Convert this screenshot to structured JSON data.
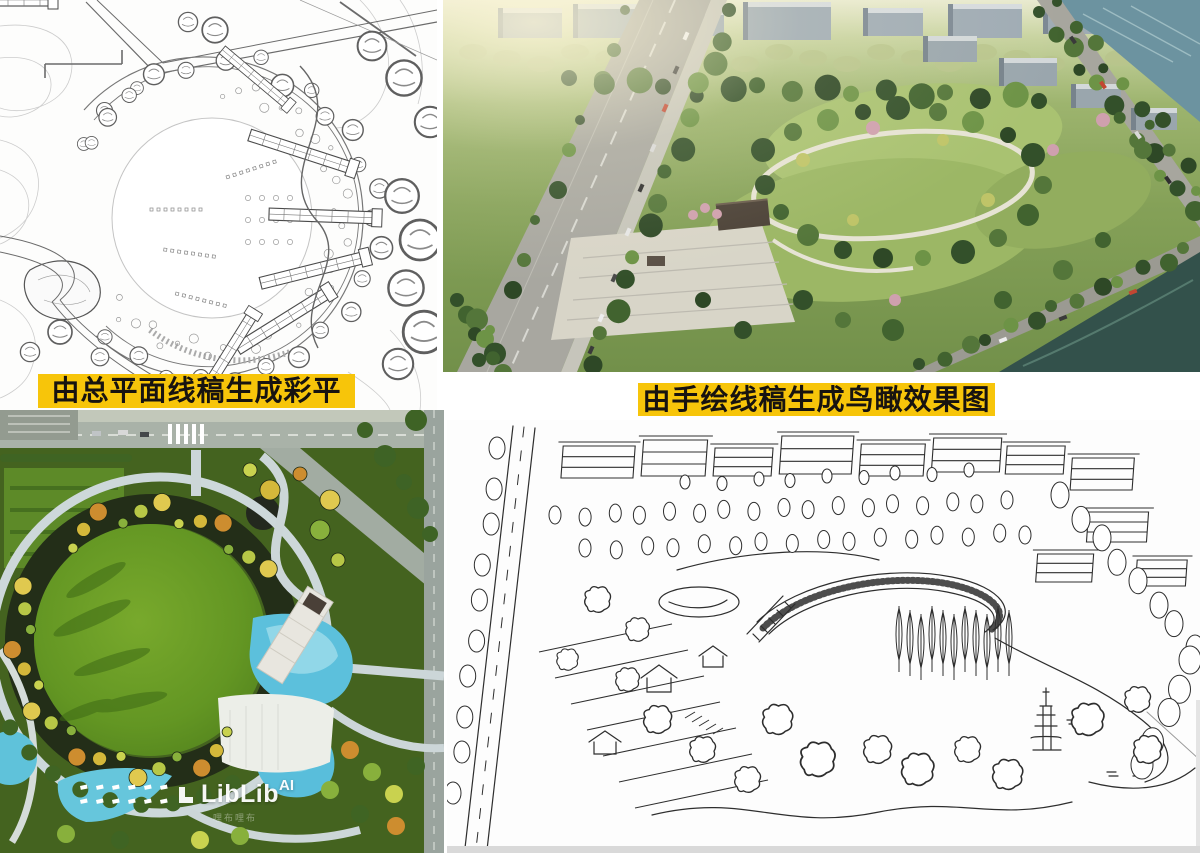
{
  "canvas": {
    "width": 1200,
    "height": 853,
    "background": "#ffffff"
  },
  "captions": {
    "left_banner": {
      "text": "由总平面线稿生成彩平",
      "bg": "#F7C50A",
      "color": "#171310"
    },
    "right_banner": {
      "text": "由手绘线稿生成鸟瞰效果图",
      "bg": "#F7C50A",
      "color": "#171310"
    }
  },
  "watermark": {
    "brand_main": "LibLib",
    "brand_suffix": "AI",
    "subtext": "哩布哩布",
    "color": "#ffffff"
  },
  "panels": {
    "top_left": {
      "name": "master-plan-line-draft"
    },
    "top_right": {
      "name": "aerial-birdseye-render"
    },
    "bottom_left": {
      "name": "color-site-plan-render"
    },
    "bottom_right": {
      "name": "hand-drawn-birdseye-sketch"
    }
  },
  "palette": {
    "banner_yellow": "#F7C50A",
    "plan_ink": "#5a5a5a",
    "sketch_ink": "#2e2e2e",
    "lawn_green": "#5f9020",
    "park_green": "#85a158",
    "tree_dark": "#33502a",
    "pool_cyan": "#57bedb",
    "river_teal": "#5a7e8a",
    "road_gray": "#a6a59d",
    "plaza_light": "#d9d6c9"
  }
}
